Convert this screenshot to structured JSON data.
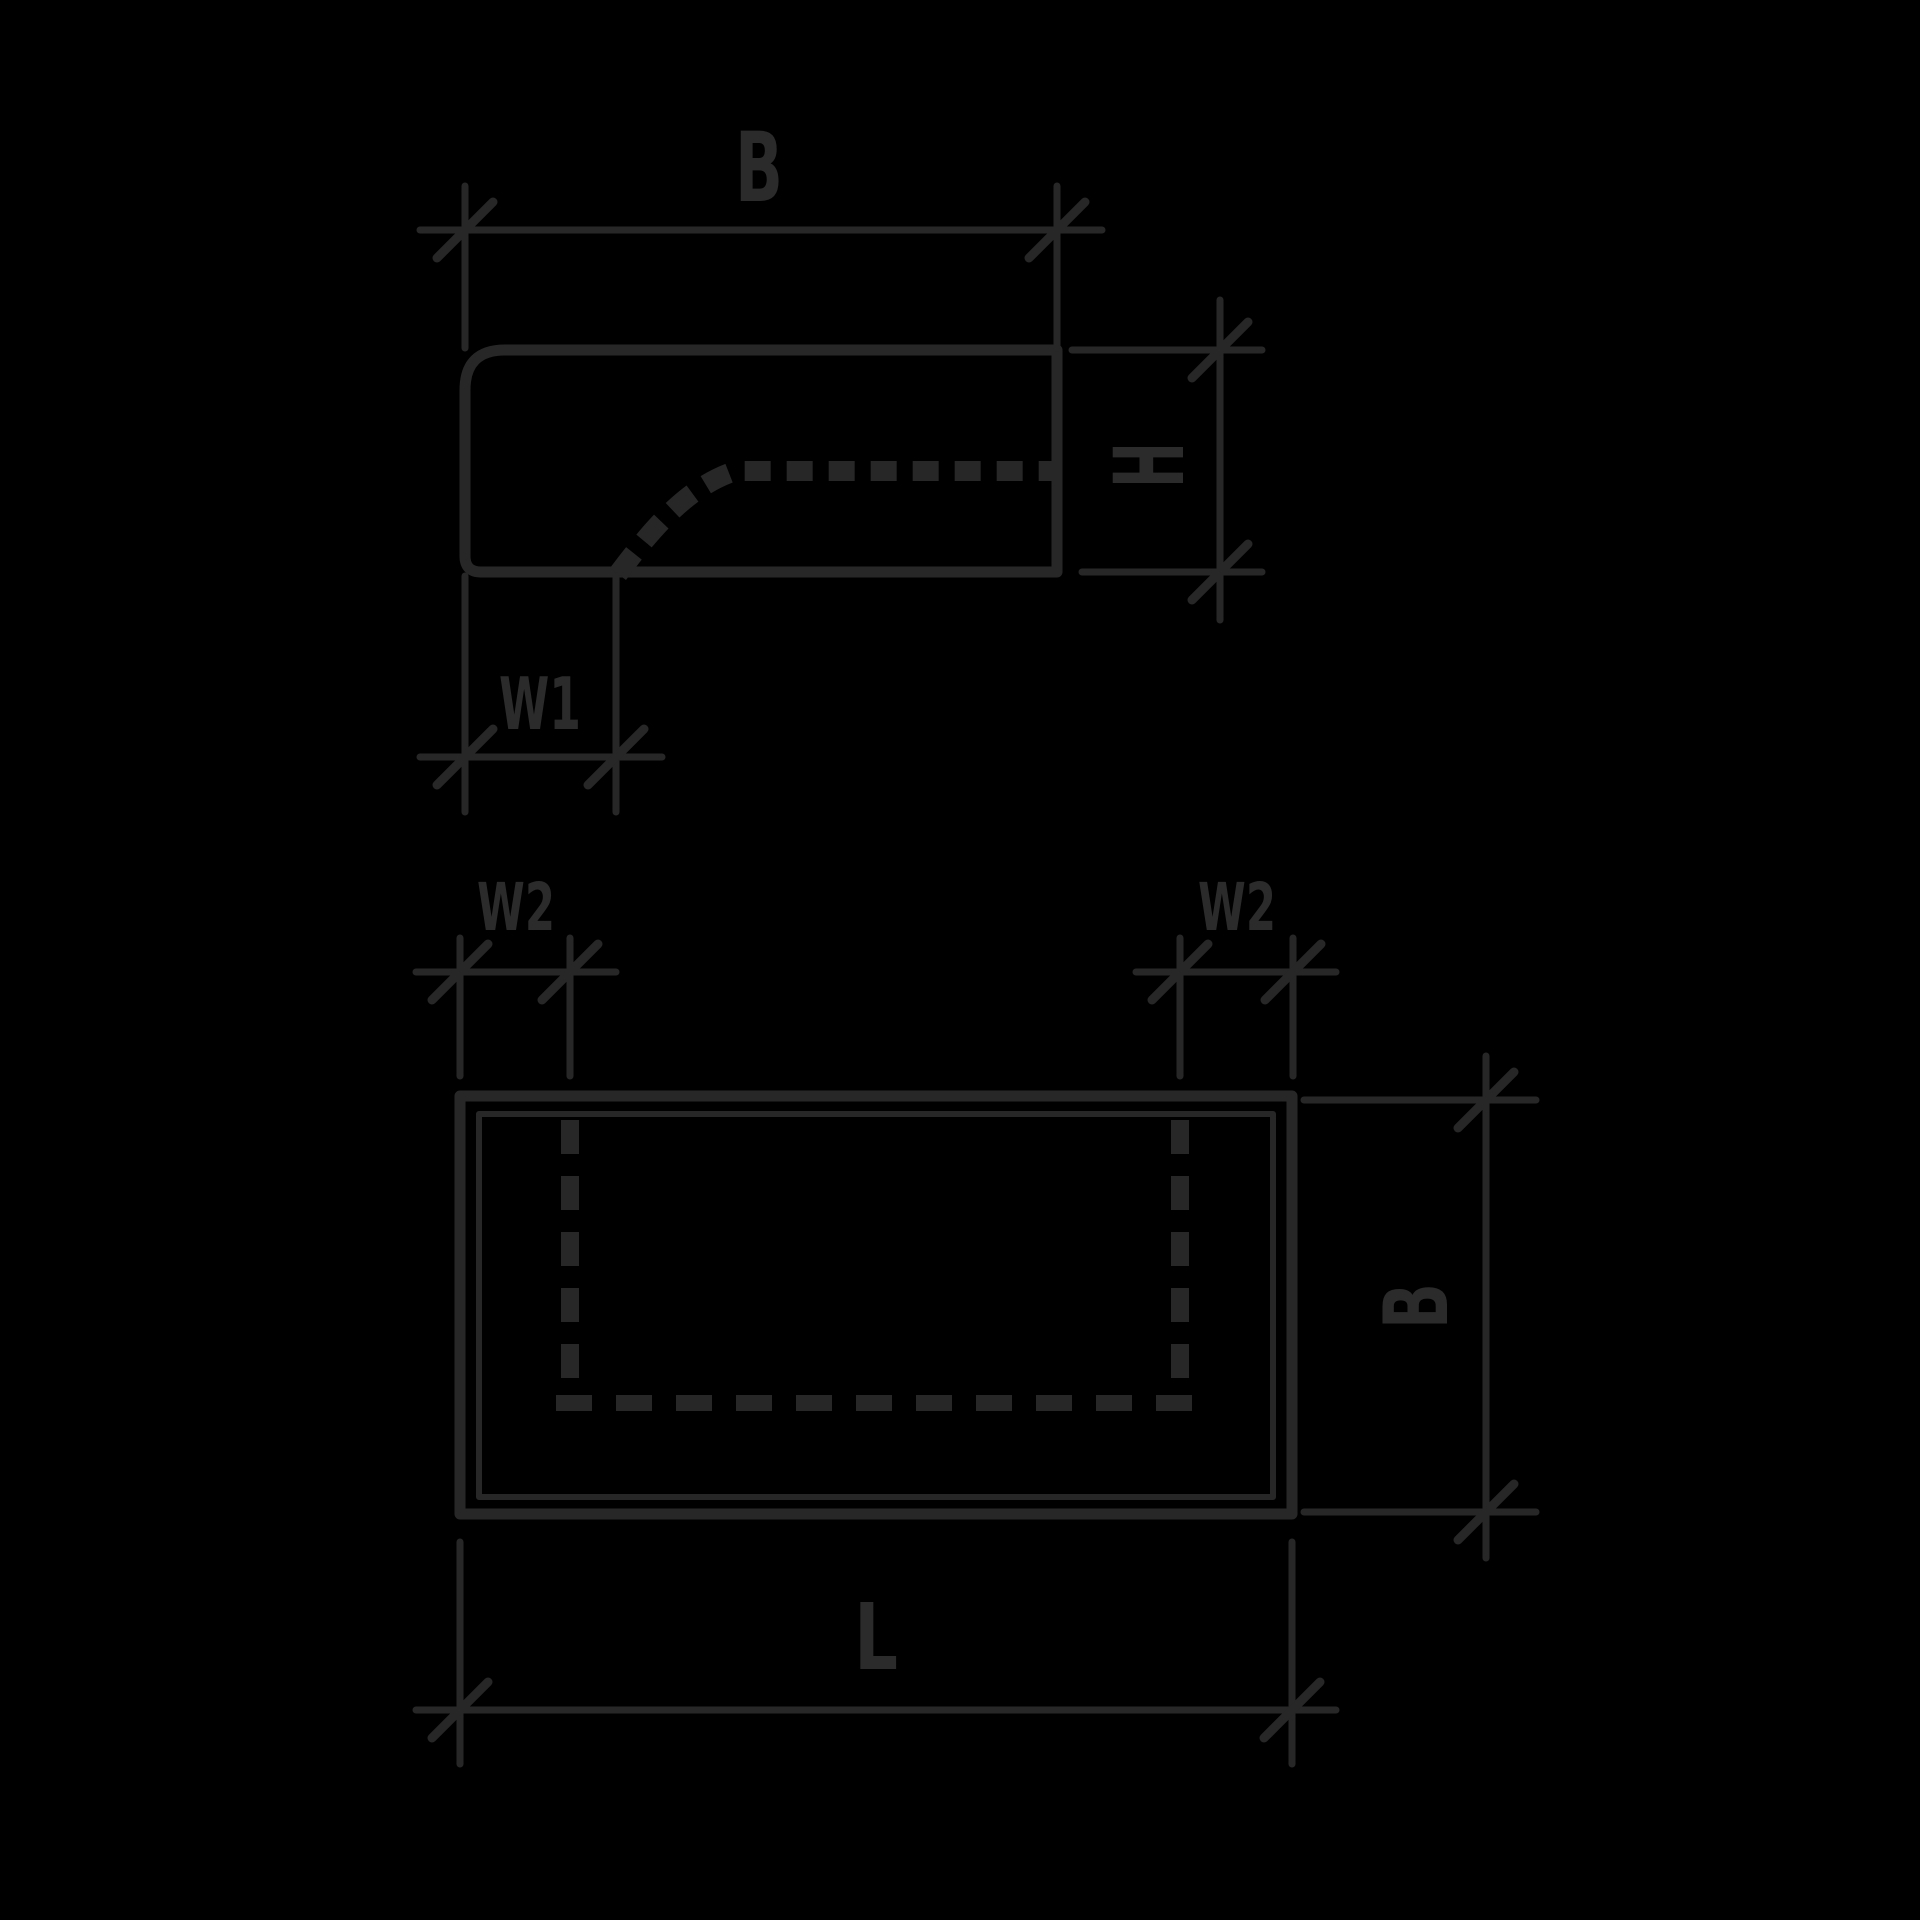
{
  "colors": {
    "background": "#000000",
    "line": "#272727",
    "text": "#2b2b2b"
  },
  "side_view": {
    "width_label": "B",
    "height_label": "H",
    "notch_width_label": "W1"
  },
  "top_view": {
    "inset_left_label": "W2",
    "inset_right_label": "W2",
    "width_label": "B",
    "length_label": "L"
  }
}
